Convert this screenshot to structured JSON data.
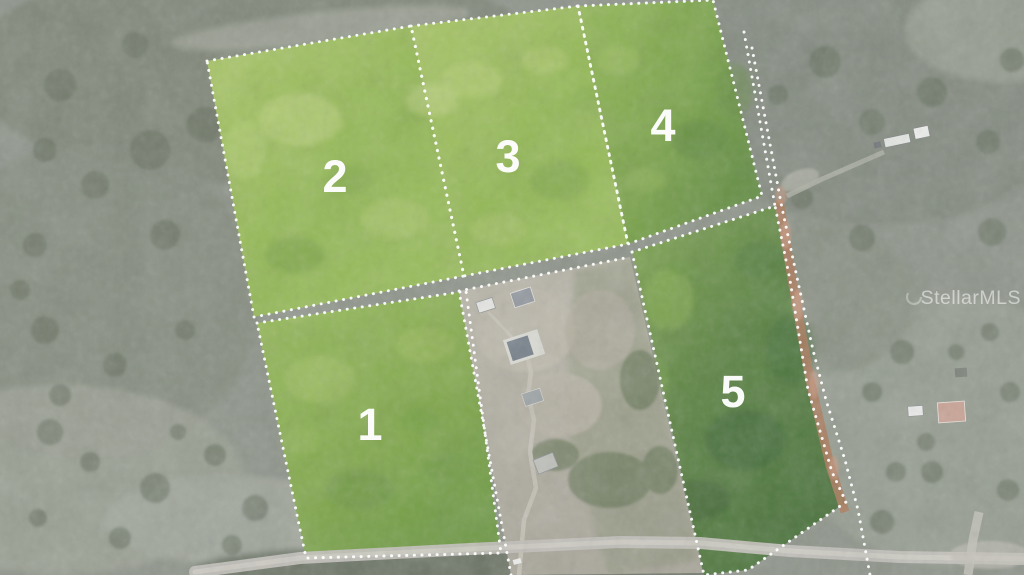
{
  "photo": {
    "description": "Aerial view of five subdivided wooded lots outlined with dotted boundaries",
    "watermark": "StellarMLS",
    "lots": [
      {
        "number": "1"
      },
      {
        "number": "2"
      },
      {
        "number": "3"
      },
      {
        "number": "4"
      },
      {
        "number": "5"
      }
    ],
    "colors": {
      "lot_green_bright": "#9dc05f",
      "lot_green_dark": "#48703b",
      "boundary_dots": "#ffffff",
      "lot_number_text": "#ffffff",
      "terrain_muted": "#8f958b",
      "dirt_road": "#b07a5e",
      "paved_road": "#c9c7c0",
      "watermark_text": "#ffffff"
    }
  }
}
